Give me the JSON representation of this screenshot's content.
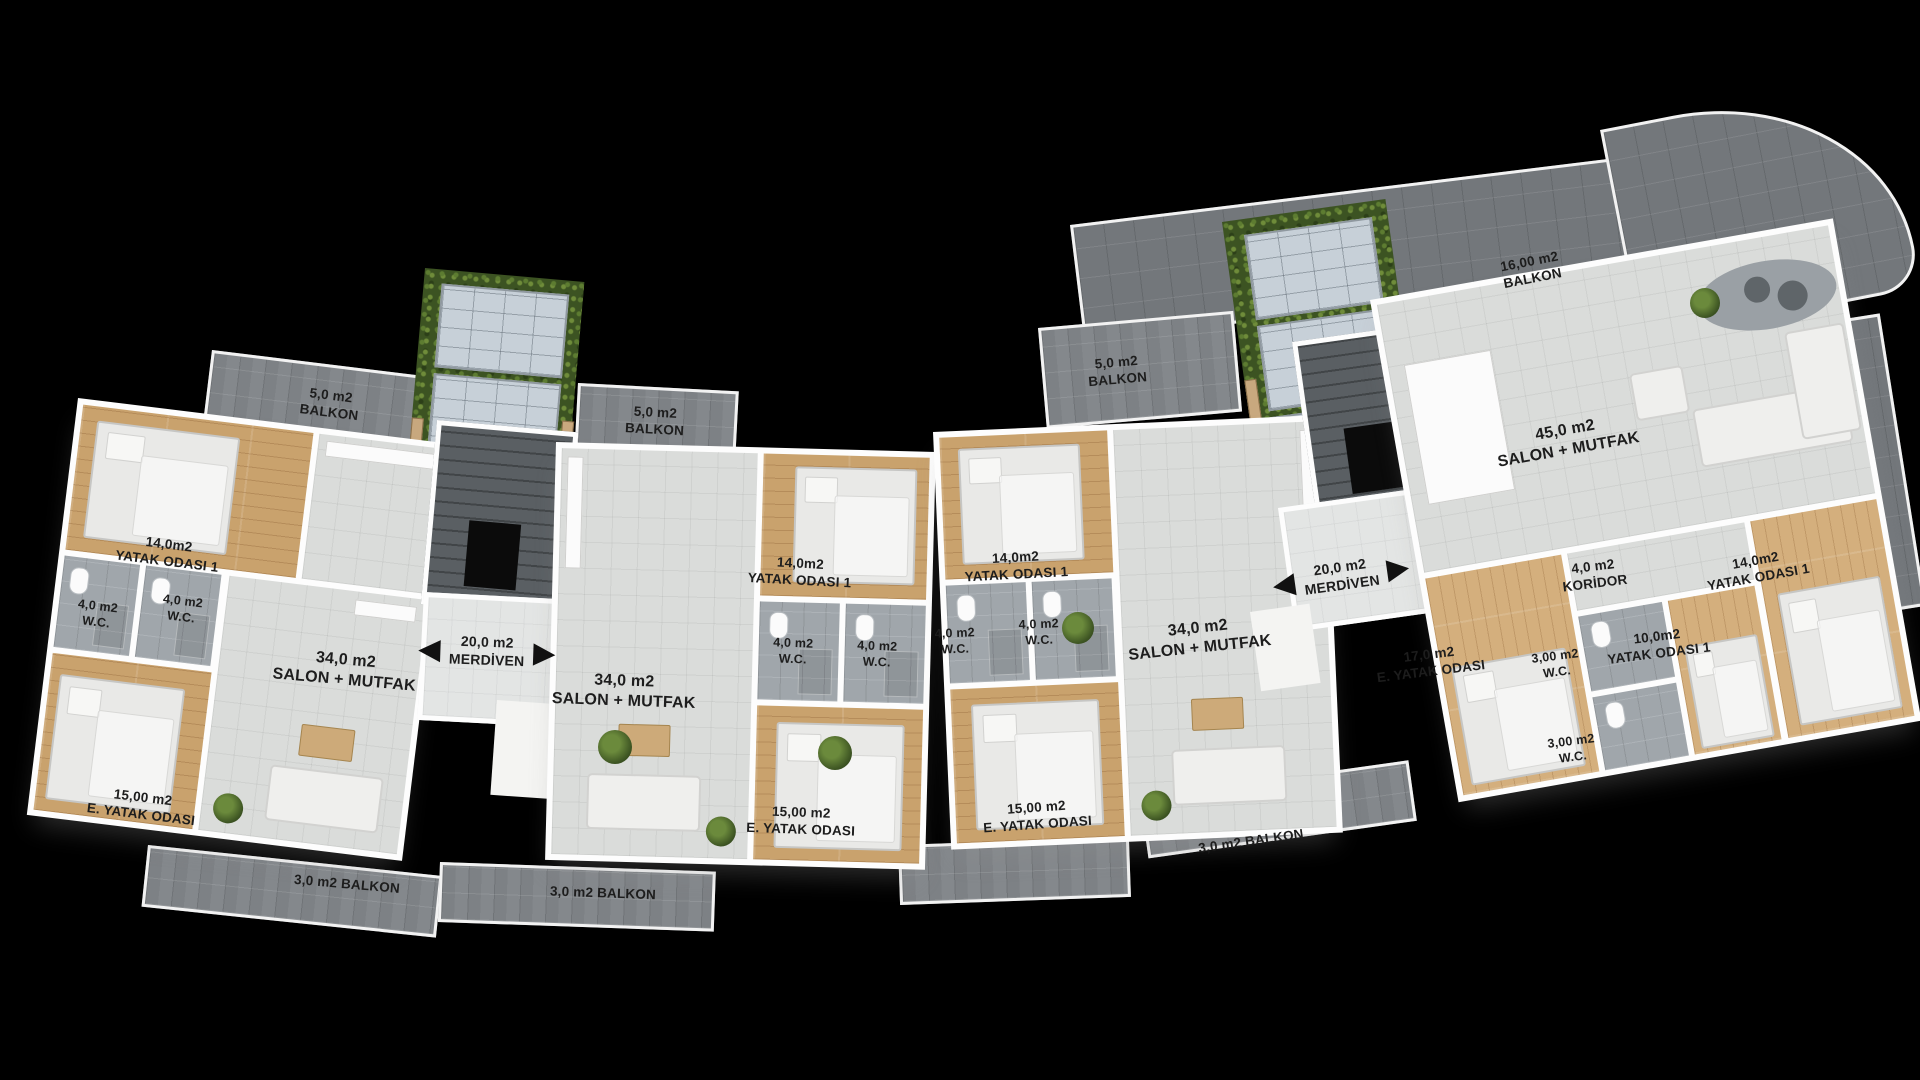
{
  "plan_title": "Apartment floor plan (Turkish labels)",
  "colors": {
    "background": "#000000",
    "wall": "#fdfdfd",
    "wood_floor": "#c9a26d",
    "salon_floor": "#dadcda",
    "wc_floor": "#a0a6ab",
    "balcony_tile": "#84888c",
    "terrace_tile": "#73777b",
    "stair_shaft": "#5a5f63",
    "green_roof": "#3c5322",
    "solar_panel": "#c7d0d8",
    "planter_wood": "#c8a87e",
    "label_text": "#1d1d1d"
  },
  "icons": {
    "stairs_arrow_left": "◀",
    "stairs_arrow_right": "▶"
  },
  "stairs": {
    "left": {
      "area": "20,0 m2",
      "name": "MERDİVEN"
    },
    "right": {
      "area": "20,0 m2",
      "name": "MERDİVEN"
    }
  },
  "apartments": {
    "apt1": {
      "balcony_top": {
        "area": "5,0 m2",
        "name": "BALKON"
      },
      "bedroom1": {
        "area": "14,0m2",
        "name": "YATAK ODASI 1"
      },
      "wc1": {
        "area": "4,0 m2",
        "name": "W.C."
      },
      "wc2": {
        "area": "4,0 m2",
        "name": "W.C."
      },
      "salon": {
        "area": "34,0 m2",
        "name": "SALON + MUTFAK"
      },
      "master_bedroom": {
        "area": "15,00 m2",
        "name": "E. YATAK ODASI"
      },
      "balcony_bottom": {
        "name": "3,0 m2 BALKON"
      }
    },
    "apt2": {
      "balcony_top": {
        "area": "5,0 m2",
        "name": "BALKON"
      },
      "salon": {
        "area": "34,0 m2",
        "name": "SALON + MUTFAK"
      },
      "bedroom1": {
        "area": "14,0m2",
        "name": "YATAK ODASI 1"
      },
      "wc1": {
        "area": "4,0 m2",
        "name": "W.C."
      },
      "wc2": {
        "area": "4,0 m2",
        "name": "W.C."
      },
      "master_bedroom": {
        "area": "15,00 m2",
        "name": "E. YATAK ODASI"
      },
      "balcony_bottom": {
        "name": "3,0 m2 BALKON"
      }
    },
    "apt3": {
      "balcony_top": {
        "area": "5,0 m2",
        "name": "BALKON"
      },
      "bedroom1": {
        "area": "14,0m2",
        "name": "YATAK ODASI 1"
      },
      "wc1": {
        "area": "4,0 m2",
        "name": "W.C."
      },
      "wc2": {
        "area": "4,0 m2",
        "name": "W.C."
      },
      "master_bedroom": {
        "area": "15,00 m2",
        "name": "E. YATAK ODASI"
      },
      "salon": {
        "area": "34,0 m2",
        "name": "SALON + MUTFAK"
      },
      "balcony_bottom": {
        "name": "3,0 m2 BALKON"
      }
    },
    "apt4": {
      "balcony_top": {
        "area": "16,00 m2",
        "name": "BALKON"
      },
      "salon": {
        "area": "45,0 m2",
        "name": "SALON + MUTFAK"
      },
      "corridor": {
        "area": "4,0 m2",
        "name": "KORİDOR"
      },
      "bedroom1": {
        "area": "14,0m2",
        "name": "YATAK ODASI 1"
      },
      "bedroom2": {
        "area": "10,0m2",
        "name": "YATAK ODASI 1"
      },
      "master_bedroom": {
        "area": "17,0 m2",
        "name": "E. YATAK ODASI"
      },
      "wc1": {
        "area": "3,00 m2",
        "name": "W.C."
      },
      "wc2": {
        "area": "3,00 m2",
        "name": "W.C."
      }
    }
  }
}
